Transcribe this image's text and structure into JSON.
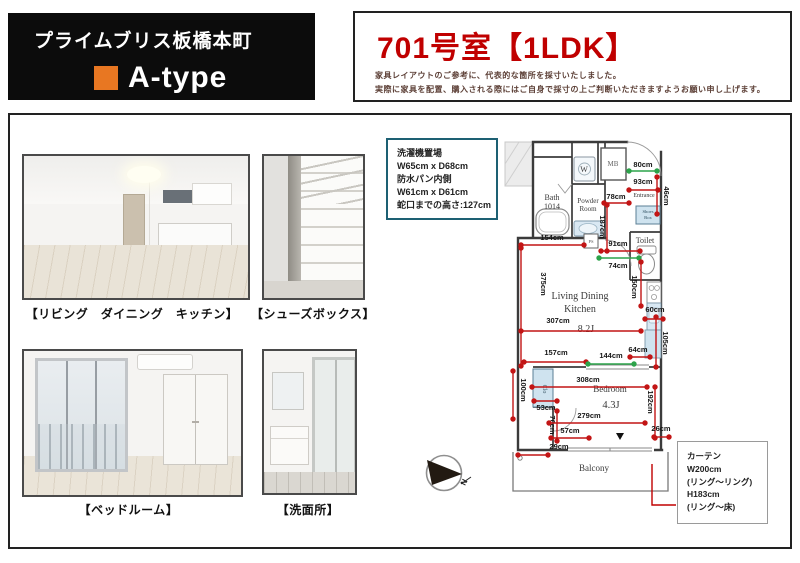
{
  "header": {
    "building": "プライムブリス板橋本町",
    "type_label": "A-type",
    "accent_color": "#e87722"
  },
  "title": {
    "room": "701号室【1LDK】",
    "color": "#c00000",
    "notes": [
      "家具レイアウトのご参考に、代表的な箇所を採寸いたしました。",
      "実際に家具を配置、購入される際にはご自身で採寸の上ご判断いただきますようお願い申し上げます。"
    ]
  },
  "photos": [
    {
      "caption": "【リビング　ダイニング　キッチン】"
    },
    {
      "caption": "【シューズボックス】"
    },
    {
      "caption": "【ベッドルーム】"
    },
    {
      "caption": "【洗面所】"
    }
  ],
  "wash_note": {
    "border_color": "#1d6073",
    "lines": [
      "洗濯機置場",
      "W65cm x D68cm",
      "防水パン内側",
      "W61cm x D61cm",
      "蛇口までの高さ:127cm"
    ]
  },
  "curtain_note": {
    "lines": [
      "カーテン",
      "W200cm",
      "(リング〜リング)",
      "H183cm",
      "(リング〜床)"
    ]
  },
  "compass": {
    "label": "N"
  },
  "floorplan": {
    "red": "#c21515",
    "green": "#2ca34a",
    "labels": [
      {
        "t": "Bath",
        "x": 552,
        "y": 200,
        "fs": 8
      },
      {
        "t": "1014",
        "x": 552,
        "y": 209,
        "fs": 8
      },
      {
        "t": "W",
        "x": 584,
        "y": 172,
        "fs": 8
      },
      {
        "t": "Powder",
        "x": 588,
        "y": 203,
        "fs": 7
      },
      {
        "t": "Room",
        "x": 588,
        "y": 211,
        "fs": 7
      },
      {
        "t": "MB",
        "x": 613,
        "y": 166,
        "fs": 7,
        "fill": "#666"
      },
      {
        "t": "Entrance",
        "x": 644,
        "y": 197,
        "fs": 6
      },
      {
        "t": "Shoes",
        "x": 648,
        "y": 213,
        "fs": 4.6,
        "fill": "#2f4f5f"
      },
      {
        "t": "Box",
        "x": 648,
        "y": 219,
        "fs": 4.6,
        "fill": "#2f4f5f"
      },
      {
        "t": "Toilet",
        "x": 645,
        "y": 243,
        "fs": 8
      },
      {
        "t": "PS",
        "x": 591,
        "y": 243,
        "fs": 4.6,
        "fill": "#555"
      },
      {
        "t": "Living Dining",
        "x": 580,
        "y": 299,
        "fs": 10
      },
      {
        "t": "Kitchen",
        "x": 580,
        "y": 312,
        "fs": 10
      },
      {
        "t": "8.2J",
        "x": 586,
        "y": 332,
        "fs": 10
      },
      {
        "t": "Bedroom",
        "x": 610,
        "y": 392,
        "fs": 9
      },
      {
        "t": "4.3J",
        "x": 611,
        "y": 408,
        "fs": 10.5
      },
      {
        "t": "Clo",
        "x": 543,
        "y": 389,
        "fs": 6,
        "rot": 1,
        "fill": "#44606e"
      },
      {
        "t": "Balcony",
        "x": 594,
        "y": 471,
        "fs": 9
      }
    ],
    "measurements": [
      {
        "t": "80cm",
        "x1": 629,
        "y1": 171,
        "x2": 657,
        "y2": 171,
        "lx": 643,
        "ly": 167,
        "c": "g"
      },
      {
        "t": "93cm",
        "x1": 629,
        "y1": 190,
        "x2": 658,
        "y2": 190,
        "lx": 643,
        "ly": 184,
        "c": "r"
      },
      {
        "t": "78cm",
        "x1": 604,
        "y1": 203,
        "x2": 629,
        "y2": 203,
        "lx": 616,
        "ly": 199,
        "c": "r"
      },
      {
        "t": "187cm",
        "x1": 607,
        "y1": 205,
        "x2": 607,
        "y2": 251,
        "lx": 600,
        "ly": 227,
        "c": "r",
        "rot": 1
      },
      {
        "t": "46cm",
        "x1": 657,
        "y1": 177,
        "x2": 657,
        "y2": 214,
        "lx": 664,
        "ly": 196,
        "c": "r",
        "rot": 1
      },
      {
        "t": "154cm",
        "x1": 521,
        "y1": 245,
        "x2": 584,
        "y2": 245,
        "lx": 552,
        "ly": 240,
        "c": "r"
      },
      {
        "t": "91cm",
        "x1": 601,
        "y1": 251,
        "x2": 640,
        "y2": 251,
        "lx": 618,
        "ly": 246,
        "c": "r"
      },
      {
        "t": "74cm",
        "x1": 599,
        "y1": 258,
        "x2": 639,
        "y2": 258,
        "lx": 618,
        "ly": 268,
        "c": "g"
      },
      {
        "t": "375cm",
        "x1": 521,
        "y1": 248,
        "x2": 521,
        "y2": 366,
        "lx": 541,
        "ly": 284,
        "c": "r",
        "rot": 1
      },
      {
        "t": "150cm",
        "x1": 641,
        "y1": 262,
        "x2": 641,
        "y2": 306,
        "lx": 632,
        "ly": 287,
        "c": "r",
        "rot": 1
      },
      {
        "t": "307cm",
        "x1": 521,
        "y1": 331,
        "x2": 641,
        "y2": 331,
        "lx": 558,
        "ly": 323,
        "c": "r"
      },
      {
        "t": "60cm",
        "x1": 645,
        "y1": 319,
        "x2": 663,
        "y2": 319,
        "lx": 655,
        "ly": 312,
        "c": "r"
      },
      {
        "t": "105cm",
        "x1": 656,
        "y1": 317,
        "x2": 656,
        "y2": 367,
        "lx": 663,
        "ly": 343,
        "c": "r",
        "rot": 1
      },
      {
        "t": "157cm",
        "x1": 524,
        "y1": 362,
        "x2": 586,
        "y2": 362,
        "lx": 556,
        "ly": 355,
        "c": "r"
      },
      {
        "t": "144cm",
        "x1": 588,
        "y1": 364,
        "x2": 634,
        "y2": 364,
        "lx": 611,
        "ly": 358,
        "c": "g"
      },
      {
        "t": "64cm",
        "x1": 630,
        "y1": 357,
        "x2": 650,
        "y2": 357,
        "lx": 638,
        "ly": 352,
        "c": "r"
      },
      {
        "t": "308cm",
        "x1": 532,
        "y1": 387,
        "x2": 647,
        "y2": 387,
        "lx": 588,
        "ly": 382,
        "c": "r"
      },
      {
        "t": "100cm",
        "x1": 513,
        "y1": 371,
        "x2": 513,
        "y2": 419,
        "lx": 521,
        "ly": 390,
        "c": "r",
        "rot": 1
      },
      {
        "t": "53cm",
        "x1": 534,
        "y1": 401,
        "x2": 557,
        "y2": 401,
        "lx": 546,
        "ly": 410,
        "c": "r"
      },
      {
        "t": "70cm",
        "x1": 557,
        "y1": 411,
        "x2": 557,
        "y2": 441,
        "lx": 550,
        "ly": 425,
        "c": "r",
        "rot": 1
      },
      {
        "t": "279cm",
        "x1": 549,
        "y1": 423,
        "x2": 645,
        "y2": 423,
        "lx": 589,
        "ly": 418,
        "c": "r"
      },
      {
        "t": "192cm",
        "x1": 655,
        "y1": 387,
        "x2": 655,
        "y2": 438,
        "lx": 648,
        "ly": 402,
        "c": "r",
        "rot": 1
      },
      {
        "t": "57cm",
        "x1": 551,
        "y1": 438,
        "x2": 589,
        "y2": 438,
        "lx": 570,
        "ly": 433,
        "c": "r"
      },
      {
        "t": "26cm",
        "x1": 654,
        "y1": 437,
        "x2": 669,
        "y2": 437,
        "lx": 661,
        "ly": 431,
        "c": "r"
      },
      {
        "t": "29cm",
        "x1": 518,
        "y1": 455,
        "x2": 548,
        "y2": 455,
        "lx": 559,
        "ly": 449,
        "c": "r"
      }
    ]
  }
}
